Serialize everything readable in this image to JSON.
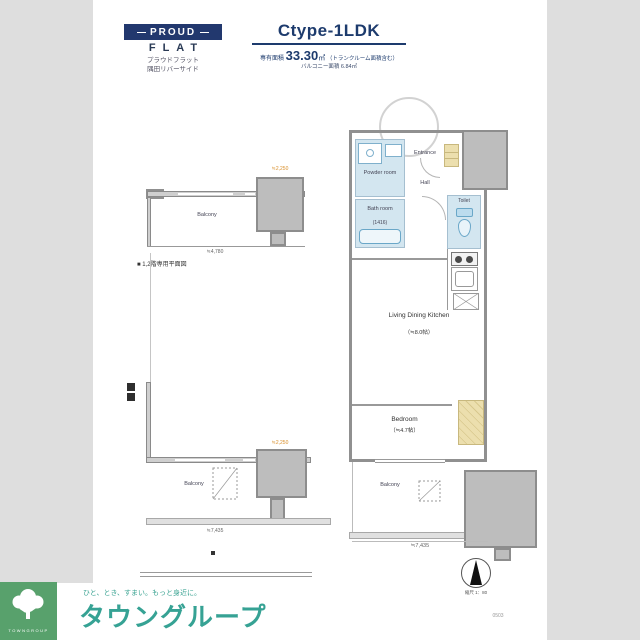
{
  "colors": {
    "accent_navy": "#1d3b6d",
    "teal": "#38a292",
    "logo_green": "#58a16c",
    "wet_room_blue": "#d3e6f0",
    "closet_beige": "#ecdfae",
    "band_gray": "#dedede",
    "block_gray": "#bdbdbd",
    "highlight_orange": "#d98f2b"
  },
  "header": {
    "proud": "PROUD",
    "flat": "FLAT",
    "property_line1": "プラウドフラット",
    "property_line2": "隅田リバーサイド",
    "type_title": "Ctype-1LDK",
    "area_prefix": "専有面積",
    "area_value": "33.30",
    "area_unit": "㎡",
    "area_note": "（トランクルーム面積含む）",
    "area_sub": "バルコニー面積 6.84㎡"
  },
  "main_plan": {
    "entrance": "Entrance",
    "hall": "Hall",
    "powder": "Powder room",
    "bath": "Bath room",
    "bath_size": "(1416)",
    "toilet": "Toilet",
    "ldk": "Living Dining Kitchen",
    "ldk_size": "（≒8.0帖）",
    "bedroom": "Bedroom",
    "bedroom_size": "（≒4.7帖）",
    "balcony": "Balcony",
    "dim_width": "≒7,435"
  },
  "plan_upper": {
    "balcony": "Balcony",
    "dim": "≒4,780",
    "dim_highlight": "≒2,250",
    "note": "■ 1,2階専用平面図"
  },
  "plan_lower": {
    "balcony": "Balcony",
    "dim": "≒7,435",
    "dim_highlight": "≒2,250"
  },
  "compass": {
    "scale": "縮尺 1：80",
    "code": "0503"
  },
  "footer": {
    "logo_caption": "TOWNGROUP",
    "slogan": "ひと、とき、すまい。もっと身近に。",
    "brand": "タウングループ"
  }
}
